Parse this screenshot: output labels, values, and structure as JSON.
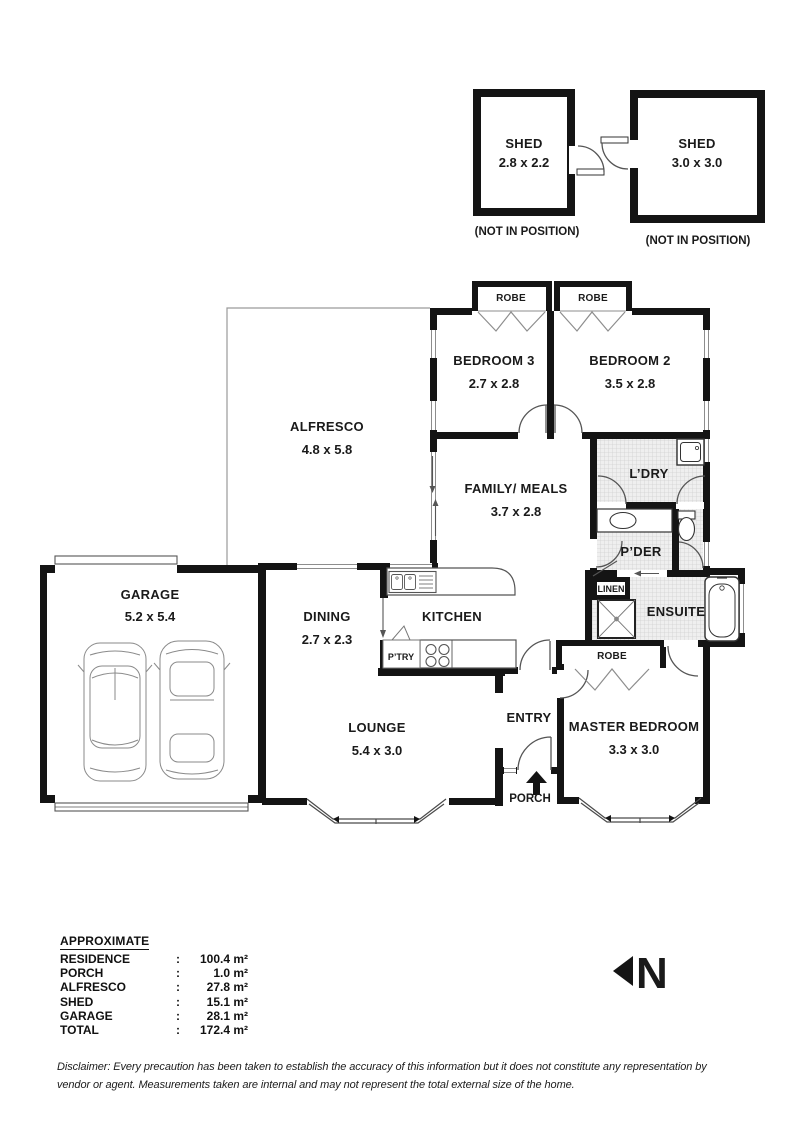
{
  "colors": {
    "wall": "#141414",
    "hatch": "#d9d9d9",
    "arc": "#555555",
    "accent": "#888888"
  },
  "sheds": [
    {
      "name": "SHED",
      "dims": "2.8 x 2.2",
      "caption": "(NOT IN POSITION)"
    },
    {
      "name": "SHED",
      "dims": "3.0 x 3.0",
      "caption": "(NOT IN POSITION)"
    }
  ],
  "rooms": {
    "bedroom3": {
      "label": "BEDROOM 3",
      "dims": "2.7 x 2.8"
    },
    "bedroom2": {
      "label": "BEDROOM 2",
      "dims": "3.5 x 2.8"
    },
    "alfresco": {
      "label": "ALFRESCO",
      "dims": "4.8 x 5.8"
    },
    "family": {
      "label": "FAMILY/ MEALS",
      "dims": "3.7 x 2.8"
    },
    "laundry": {
      "label": "L’DRY"
    },
    "powder": {
      "label": "P’DER"
    },
    "linen": {
      "label": "LINEN"
    },
    "ensuite": {
      "label": "ENSUITE"
    },
    "robe1": {
      "label": "ROBE"
    },
    "robe2": {
      "label": "ROBE"
    },
    "robe_master": {
      "label": "ROBE"
    },
    "master": {
      "label": "MASTER BEDROOM",
      "dims": "3.3 x 3.0"
    },
    "entry": {
      "label": "ENTRY"
    },
    "porch": {
      "label": "PORCH"
    },
    "lounge": {
      "label": "LOUNGE",
      "dims": "5.4 x 3.0"
    },
    "dining": {
      "label": "DINING",
      "dims": "2.7 x 2.3"
    },
    "kitchen": {
      "label": "KITCHEN"
    },
    "pantry": {
      "label": "P’TRY"
    },
    "garage": {
      "label": "GARAGE",
      "dims": "5.2 x 5.4"
    }
  },
  "areas": {
    "title": "APPROXIMATE",
    "separator": ":",
    "rows": [
      {
        "label": "RESIDENCE",
        "value": "100.4 m²"
      },
      {
        "label": "PORCH",
        "value": "1.0 m²"
      },
      {
        "label": "ALFRESCO",
        "value": "27.8 m²"
      },
      {
        "label": "SHED",
        "value": "15.1 m²"
      },
      {
        "label": "GARAGE",
        "value": "28.1 m²"
      },
      {
        "label": "TOTAL",
        "value": "172.4 m²"
      }
    ]
  },
  "north": {
    "label": "N"
  },
  "disclaimer": {
    "line1": "Disclaimer: Every precaution has been taken to establish the accuracy of this information but it does not constitute any representation by",
    "line2": "vendor or agent. Measurements taken are internal and may not represent the total external size of the home."
  }
}
